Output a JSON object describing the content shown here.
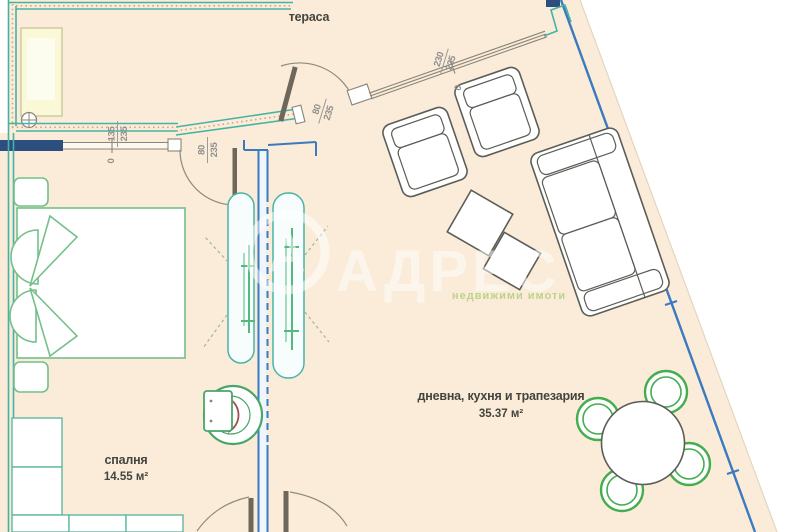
{
  "watermark": {
    "brand": "АДРЕС",
    "tagline": "недвижими имоти",
    "logo_letter": "А"
  },
  "rooms": {
    "terrace": {
      "label": "тераса"
    },
    "bedroom": {
      "label": "спалня",
      "area": "14.55 м²"
    },
    "living": {
      "label": "дневна, кухня и трапезария",
      "area": "35.37 м²"
    }
  },
  "dimensions": {
    "bedroom_window": {
      "w": "135",
      "h": "235"
    },
    "bedroom_door": {
      "w": "80",
      "h": "235"
    },
    "terrace_door": {
      "w": "80",
      "h": "235"
    },
    "living_window": {
      "w": "230",
      "h": "235"
    },
    "zero_bedroom_window": "0",
    "zero_living_window": "0"
  },
  "colors": {
    "floor": "#faecd8",
    "wall_blue": "#3b79c0",
    "wall_navy": "#2c4f80",
    "railing_teal": "#45b3a4",
    "furniture_green": "#74c08b",
    "chair_green": "#43ad4f",
    "furniture_gray": "#5d5d58",
    "door_leaf": "#6e675c",
    "dim_text": "#8f8f8f",
    "label_text": "#44443f",
    "toilet_accent": "#9b5050"
  }
}
